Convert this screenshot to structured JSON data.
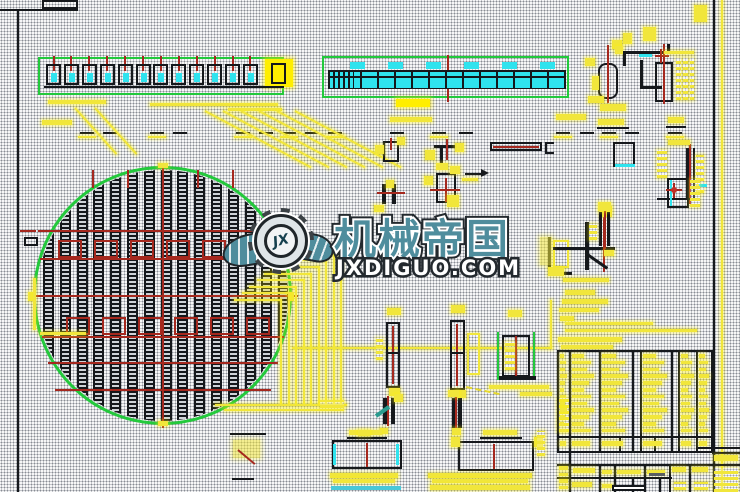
{
  "watermark": {
    "logo_icon": "winged-gear-icon",
    "logo_monogram": "JX",
    "brand_name": "机械帝国",
    "website": "JXDIGUO.COM",
    "brand_color": "#4f8d9d"
  },
  "palette": {
    "paper": "#ffffff",
    "halftone_dot": "#2e3a4a",
    "linework_black": "#15181c",
    "dimension_yellow": "#f1e63b",
    "highlight_cyan": "#2fe3ee",
    "outline_green": "#23c93c",
    "centerline_red": "#a5281e",
    "watermark_teal": "#4f8d9d"
  }
}
